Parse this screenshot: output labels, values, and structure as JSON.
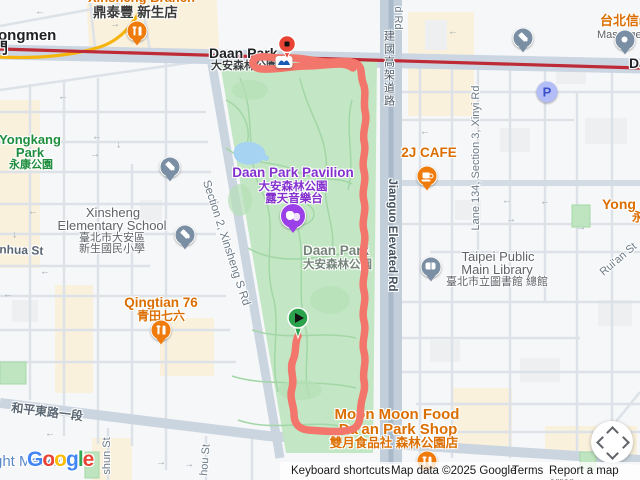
{
  "stations": {
    "dongmen_partial": "ongmen",
    "dongmen_gate": "門",
    "daan_park_en": "Daan Park",
    "daan_park_zh": "大安森林公園",
    "right_edge_partial": "Da"
  },
  "pois": {
    "din_tai_fung_branch_partial": "Xinsheng Branch",
    "din_tai_fung_zh": "鼎泰豐 新生店",
    "taipei_xinyi_partial": "台北信義",
    "massage_partial": "Massage the",
    "cafe_2j": "2J CAFE",
    "yong_partial": "Yong",
    "yong_zh_partial": "永",
    "qingtian_en": "Qingtian 76",
    "qingtian_zh": "青田七六",
    "moon_l1": "Moon Moon Food",
    "moon_l2": "Da'an Park Shop",
    "moon_zh": "雙月食品社 森林公園店",
    "library_l1": "Taipei Public",
    "library_l2": "Main Library",
    "library_zh": "臺北市立圖書館 總館",
    "school_l1": "Xinsheng",
    "school_l2": "Elementary School",
    "school_zh1": "臺北市大安區",
    "school_zh2": "新生國民小學",
    "parking_letter": "P",
    "night_market_partial": "ght Market"
  },
  "parks": {
    "yongkang_l1": "Yongkang",
    "yongkang_l2": "Park",
    "yongkang_zh": "永康公園",
    "pavilion_l1": "Daan Park Pavilion",
    "pavilion_zh1": "大安森林公園",
    "pavilion_zh2": "露天音樂台",
    "daan_name_en": "Daan Park",
    "daan_name_zh": "大安森林公園"
  },
  "roads": {
    "jianguo_zh": "建國高架道路",
    "jianguo_en": "Jianguo Elevated Rd",
    "jianguo_stub_partial": "d Rd",
    "lane134": "Lane 134, Section 3, Xinyi Rd",
    "ruian": "Rui'an St",
    "xinsheng": "Section 2, Xinsheng S Rd",
    "heping_zh": "和平東路一段",
    "shun_partial": "shun St",
    "hou_partial": "hou St",
    "inhua_partial": "inhua St"
  },
  "route": {
    "color": "#F2766B"
  },
  "transit": {
    "red_line_color": "#BE2A35",
    "yellow_line_color": "#F6B40E"
  },
  "colors": {
    "park_fill": "#C3E7C4",
    "poi_orange": "#DB6E00",
    "pavilion_purple": "#8430CE",
    "park_label_green": "#1E8E3E"
  },
  "logo": {
    "l1": "G",
    "l2": "o",
    "l3": "o",
    "l4": "g",
    "l5": "l",
    "l6": "e"
  },
  "attribution": {
    "keyboard": "Keyboard shortcuts",
    "map_data": "Map data ©2025 Google",
    "terms": "Terms",
    "report": "Report a map error"
  }
}
